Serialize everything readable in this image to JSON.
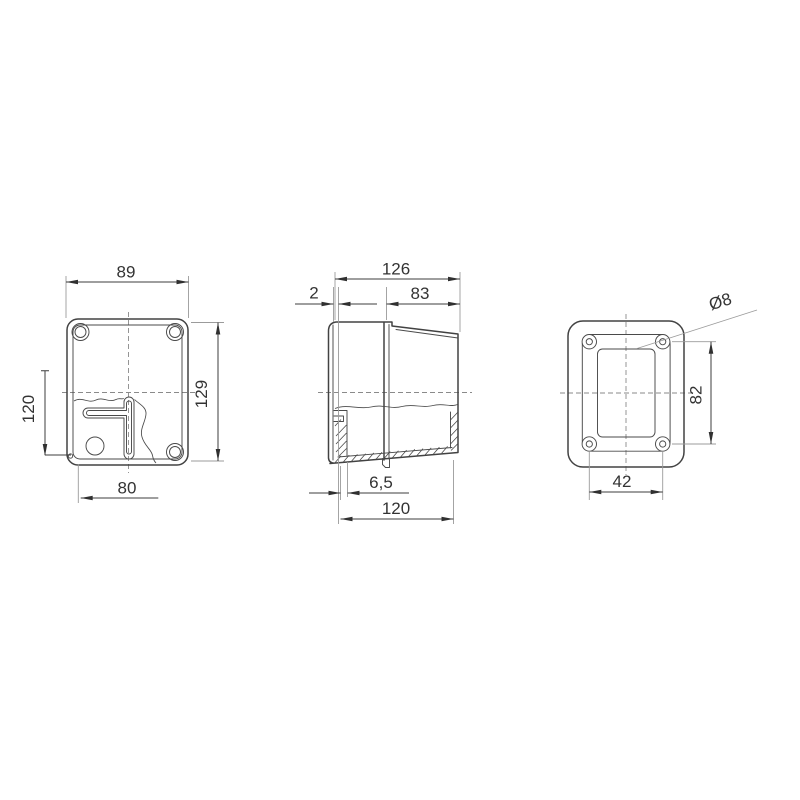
{
  "views": {
    "front": {
      "dims": {
        "width_top": "89",
        "height_right": "129",
        "mount_offset_left": "120",
        "mount_offset_bottom": "80"
      }
    },
    "side": {
      "dims": {
        "depth_overall_top": "126",
        "lid_gap": "2",
        "body_depth": "83",
        "flange_offset": "6,5",
        "depth_overall_bottom": "120"
      }
    },
    "rear": {
      "dims": {
        "mount_hole_diameter": "Ø8",
        "mount_hole_pitch_vertical": "82",
        "mount_hole_pitch_horizontal": "42"
      }
    }
  },
  "colors": {
    "background": "#ffffff",
    "object_line": "#424242",
    "thin_line": "#4a4a4a",
    "extension_line": "#9b9b9b",
    "dimension_line": "#3c3c3c",
    "arrow_fill": "#303030",
    "centerline": "#8a8a8a",
    "text": "#333333"
  }
}
